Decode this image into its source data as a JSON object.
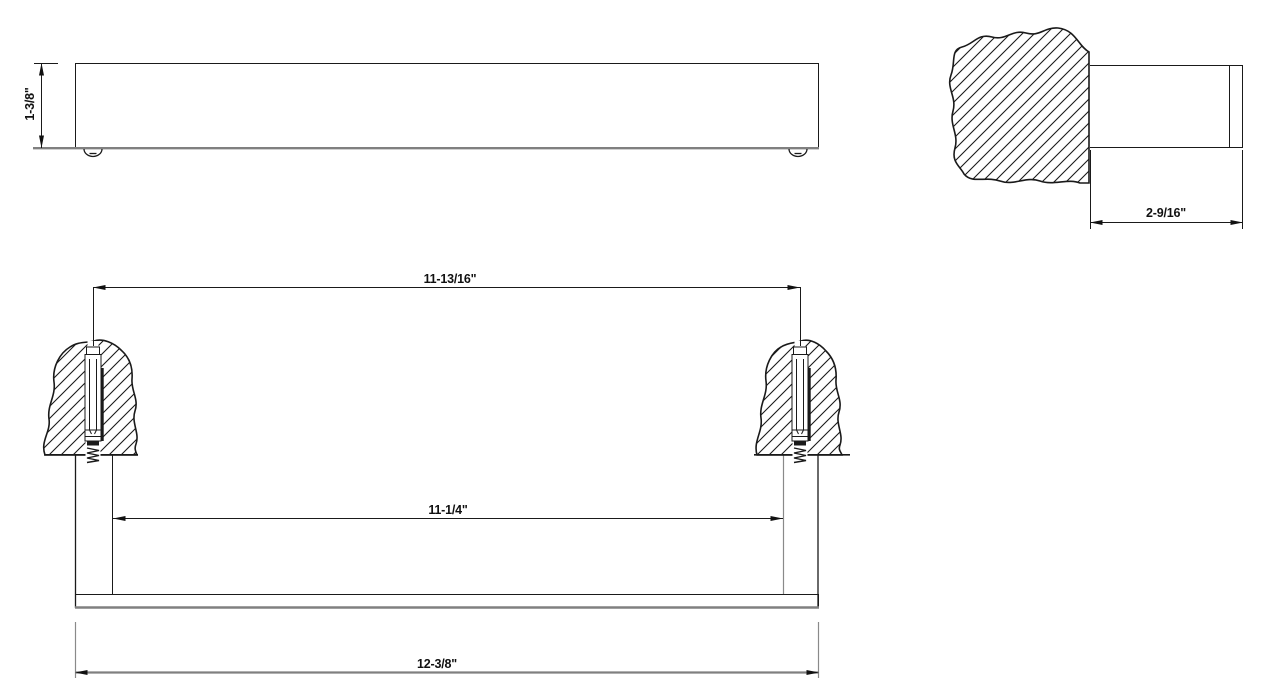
{
  "colors": {
    "line": "#1a1a1a",
    "silhouette_gray": "#808080",
    "background": "#ffffff"
  },
  "views": {
    "front": {
      "height_label": "1-3/8\""
    },
    "side": {
      "depth_label": "2-9/16\""
    },
    "installation": {
      "centers_label": "11-13/16\"",
      "inner_label": "11-1/4\"",
      "overall_label": "12-3/8\""
    }
  }
}
